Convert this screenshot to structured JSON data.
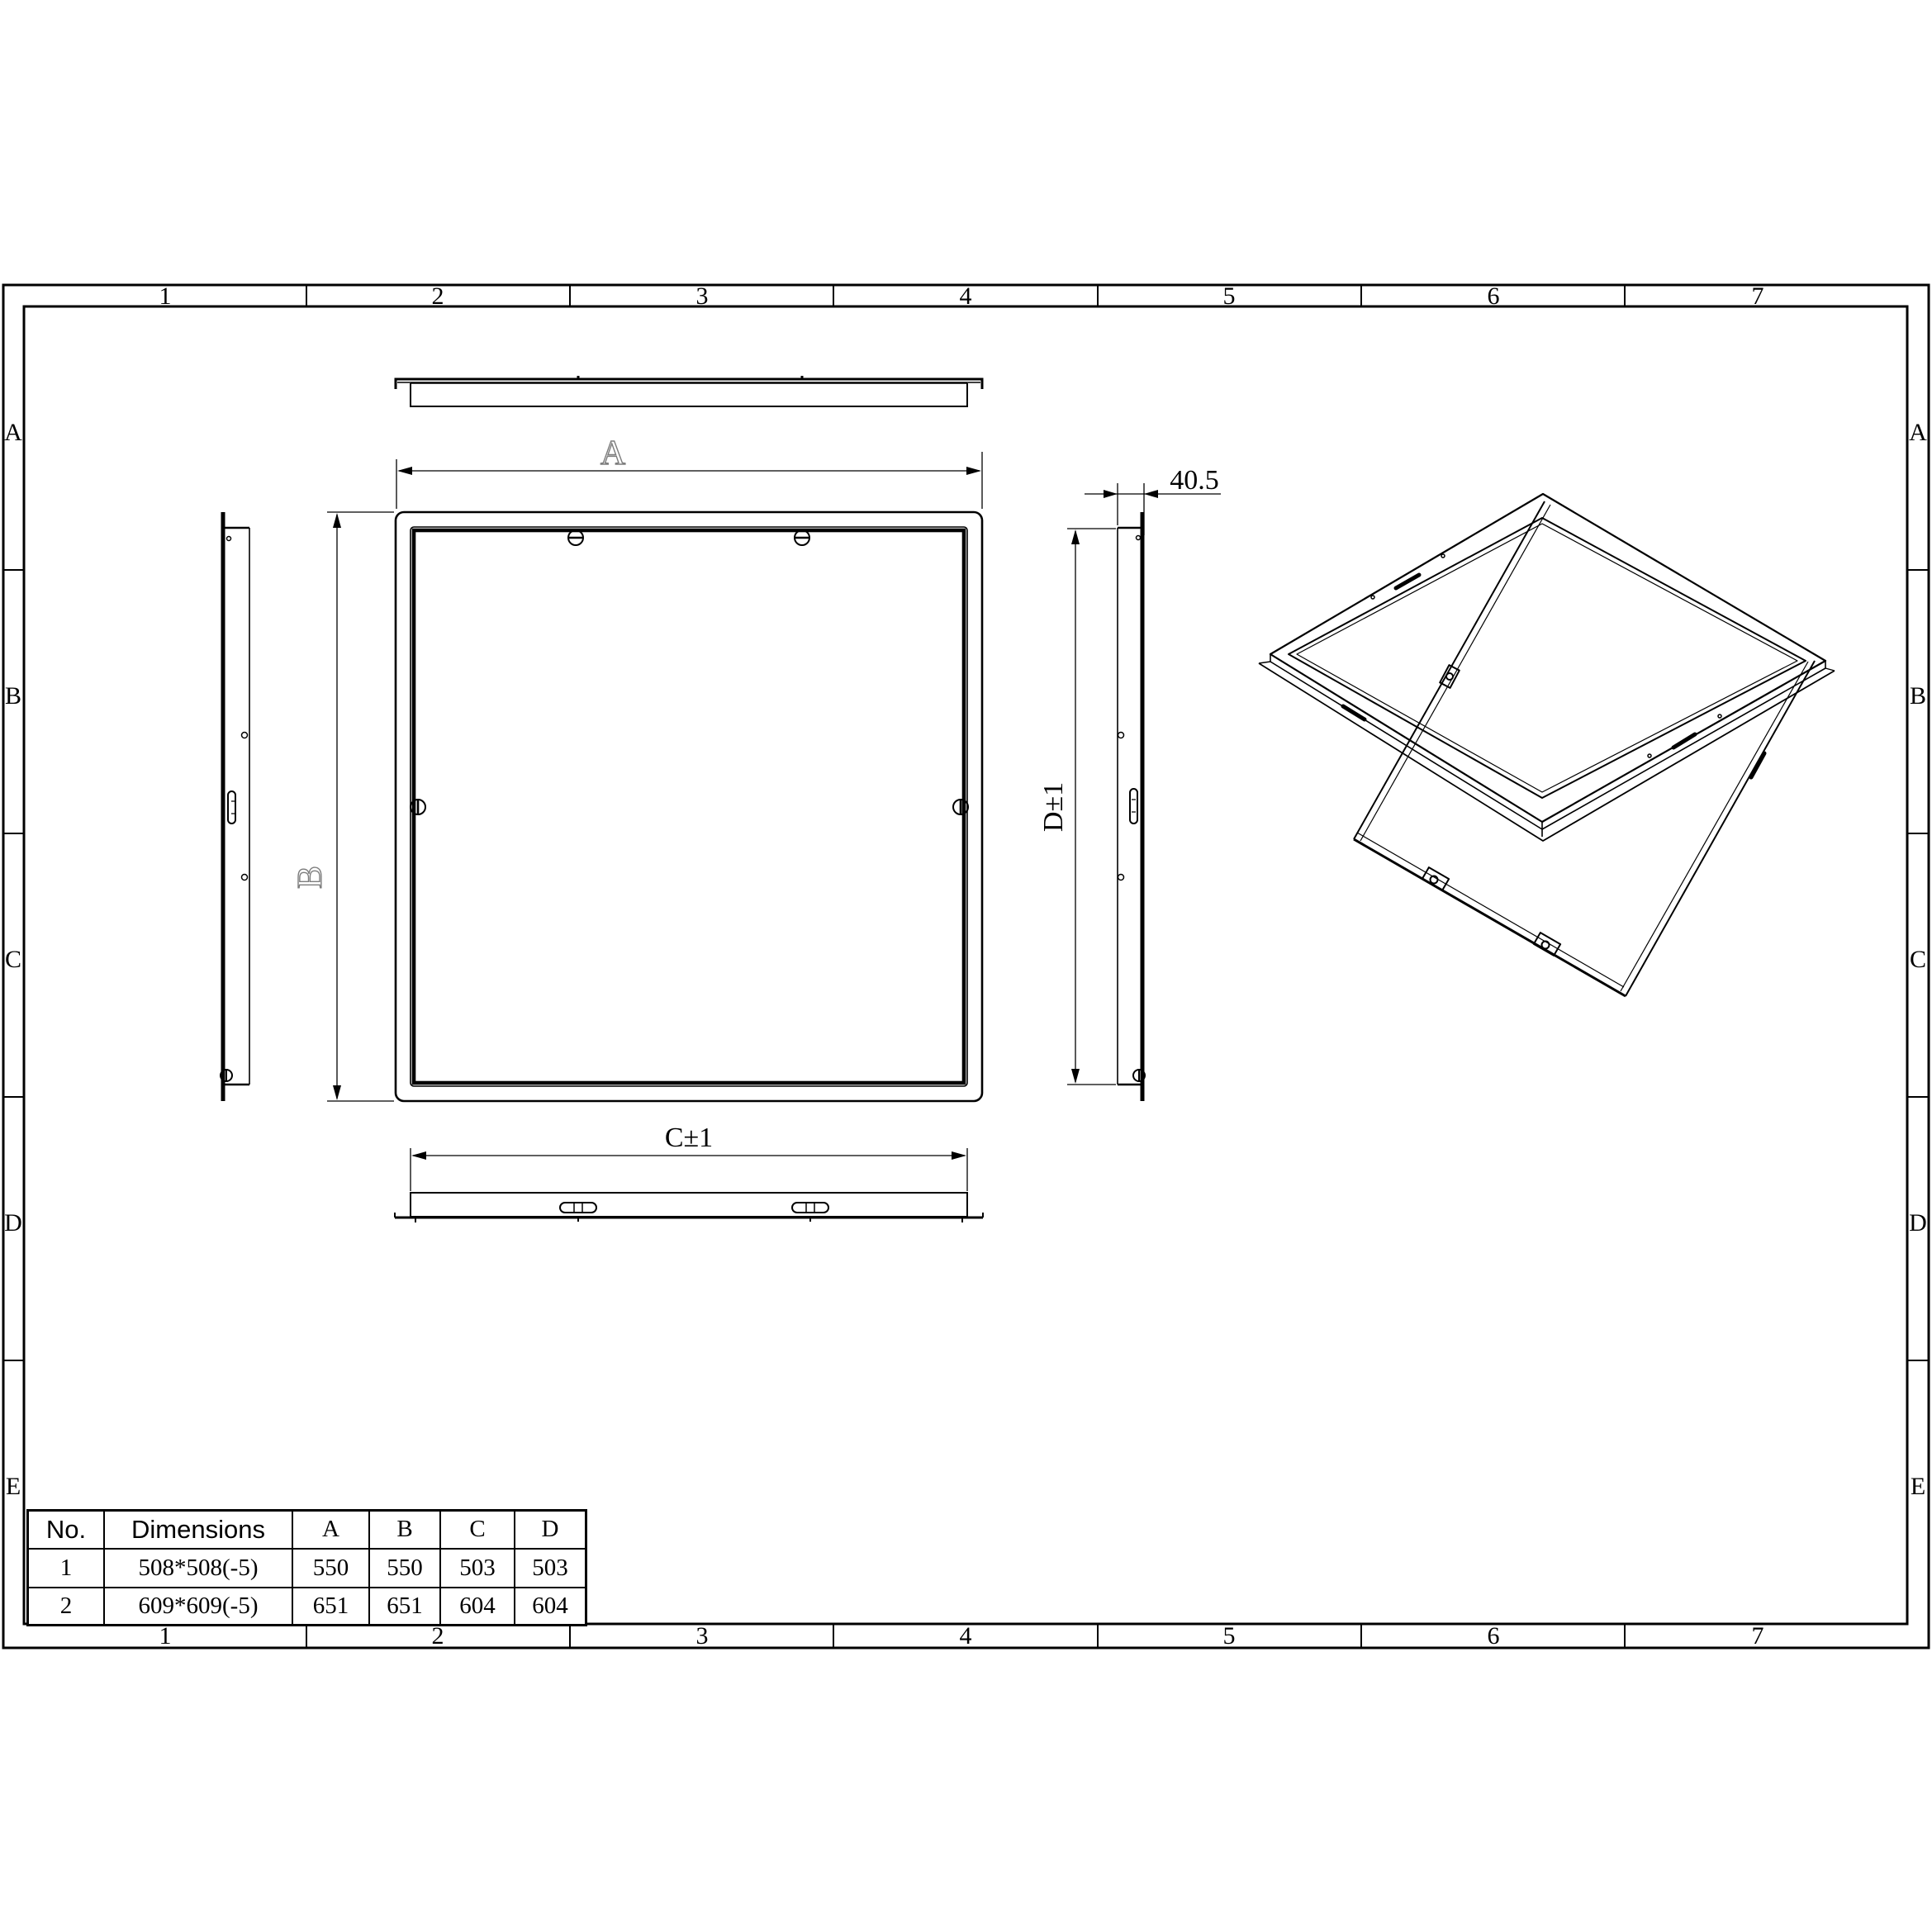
{
  "grid": {
    "columns": [
      "1",
      "2",
      "3",
      "4",
      "5",
      "6",
      "7"
    ],
    "rows": [
      "A",
      "B",
      "C",
      "D",
      "E"
    ]
  },
  "labels": {
    "outer_width": "A",
    "outer_height": "B",
    "opening_width": "C±1",
    "opening_height": "D±1",
    "depth": "40.5"
  },
  "table": {
    "headers": [
      "No.",
      "Dimensions",
      "A",
      "B",
      "C",
      "D"
    ],
    "rows": [
      {
        "no": "1",
        "dimensions": "508*508(-5)",
        "a": "550",
        "b": "550",
        "c": "503",
        "d": "503"
      },
      {
        "no": "2",
        "dimensions": "609*609(-5)",
        "a": "651",
        "b": "651",
        "c": "604",
        "d": "604"
      }
    ]
  },
  "colors": {
    "line": "#000000",
    "hollow_label_outline": "#7d7d7d"
  }
}
